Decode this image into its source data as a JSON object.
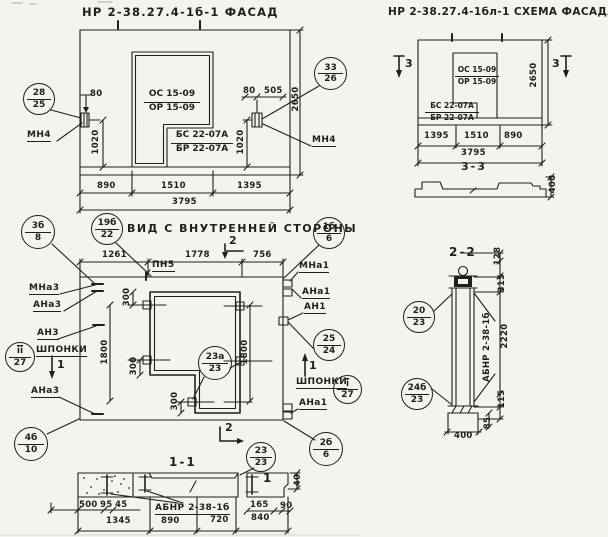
{
  "style": {
    "ink": "#1f1f1f",
    "paper": "#f4f3ee"
  },
  "facade": {
    "title": "НР 2-38.27.4-1б-1 ФАСАД",
    "window_mark": {
      "top": "ОС 15-09",
      "bottom": "ОР 15-09"
    },
    "block_mark": {
      "top": "БС 22-07А",
      "bottom": "БР 22-07А"
    },
    "anchor_left": "МН4",
    "anchor_right": "МН4",
    "balloon_left": {
      "top": "28",
      "bottom": "25"
    },
    "balloon_right": {
      "top": "33",
      "bottom": "26"
    },
    "dims": {
      "offset_left": "80",
      "offset_right": "80",
      "offset_505": "505",
      "v_left": "1020",
      "v_right": "1020",
      "w1": "890",
      "w2": "1510",
      "w3": "1395",
      "total": "3795",
      "height": "2650"
    }
  },
  "scheme": {
    "title": "НР 2-38.27.4-1бл-1 СХЕМА ФАСАДА",
    "window_mark": {
      "top": "ОС 15-09",
      "bottom": "ОР 15-09"
    },
    "block_mark": {
      "top": "БС 22-07А",
      "bottom": "БР 22-07А"
    },
    "section_left": "3",
    "section_right": "3",
    "profile_label": "3-3",
    "dims": {
      "w1": "1395",
      "w2": "1510",
      "w3": "890",
      "total": "3795",
      "height": "2650",
      "profile": "400"
    }
  },
  "inner": {
    "title": "ВИД С ВНУТРЕННЕЙ СТОРОНЫ",
    "strip_label": "ПН5",
    "dims": {
      "w1": "1261",
      "w2": "1778",
      "w3": "756",
      "v_left": "1800",
      "v_right": "1800",
      "a300_1": "300",
      "a300_2": "300",
      "a300_3": "300"
    },
    "left_labels": {
      "mna3": "МНа3",
      "ana3_top": "АНа3",
      "an3": "АН3",
      "keys": "ШПОНКИ",
      "ana3_bottom": "АНа3"
    },
    "right_labels": {
      "mna1": "МНа1",
      "ana1_top": "АНа1",
      "an1": "АН1",
      "keys": "ШПОНКИ",
      "ana1_bottom": "АНа1"
    },
    "balloons": {
      "b3b": {
        "top": "3б",
        "bottom": "8"
      },
      "b19b": {
        "top": "19б",
        "bottom": "22"
      },
      "b1b": {
        "top": "1б",
        "bottom": "6"
      },
      "bii": {
        "top": "ii",
        "bottom": "27"
      },
      "b25": {
        "top": "25",
        "bottom": "24"
      },
      "b23a": {
        "top": "23а",
        "bottom": "23"
      },
      "bi": {
        "top": "i",
        "bottom": "27"
      },
      "b4b": {
        "top": "4б",
        "bottom": "10"
      },
      "b2b": {
        "top": "2б",
        "bottom": "6"
      }
    },
    "sections": {
      "s1_down": "1",
      "s1_up": "1",
      "s2_top": "2",
      "s2_bottom": "2"
    }
  },
  "section11": {
    "title": "1-1",
    "beam_label": "АБНР 2-38-1б",
    "cut_marker": "1",
    "balloon": {
      "top": "23",
      "bottom": "23"
    },
    "dims": {
      "d500": "500",
      "d95": "95",
      "d45": "45",
      "d1345": "1345",
      "d890": "890",
      "d720": "720",
      "d165": "165",
      "d90": "90",
      "d840": "840",
      "d40": "40"
    }
  },
  "section22": {
    "title": "2-2",
    "beam_label": "АБНР 2-38-1б",
    "balloons": {
      "b20": {
        "top": "20",
        "bottom": "23"
      },
      "b24b": {
        "top": "24б",
        "bottom": "23"
      }
    },
    "dims": {
      "d128": "128",
      "d315": "315",
      "d2220": "2220",
      "d115": "115",
      "d85": "85",
      "d400": "400"
    }
  }
}
